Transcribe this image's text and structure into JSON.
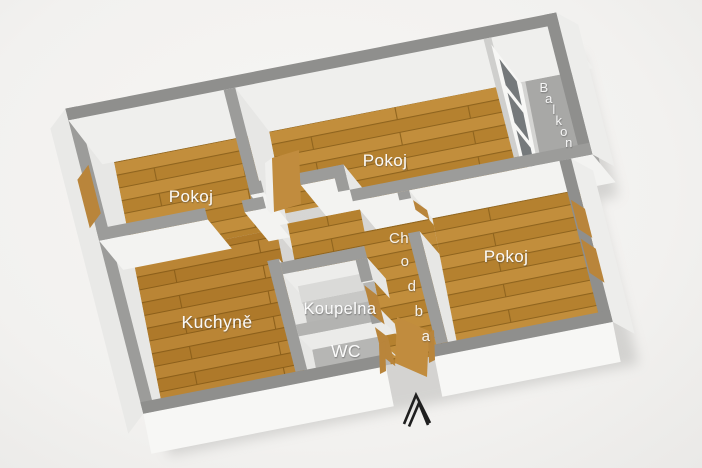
{
  "floorplan": {
    "type": "3d-floor-plan",
    "rooms": [
      {
        "id": "pokoj-left",
        "label": "Pokoj",
        "floor": "wood"
      },
      {
        "id": "pokoj-middle",
        "label": "Pokoj",
        "floor": "wood"
      },
      {
        "id": "pokoj-right",
        "label": "Pokoj",
        "floor": "wood"
      },
      {
        "id": "kuchyne",
        "label": "Kuchyně",
        "floor": "wood"
      },
      {
        "id": "koupelna",
        "label": "Koupelna",
        "floor": "tile"
      },
      {
        "id": "wc",
        "label": "WC",
        "floor": "tile"
      },
      {
        "id": "chodba",
        "label": "Chodba",
        "floor": "wood"
      },
      {
        "id": "balkon",
        "label": "Balkon",
        "floor": "concrete"
      }
    ],
    "colors": {
      "background": "#f2f1ef",
      "wall_face": "#f3f3f1",
      "wall_face_shade": "#e7e7e5",
      "wall_face_bright": "#f7f7f5",
      "wall_top": "#9c9c9a",
      "wall_top_outer": "#8f8f8d",
      "floor_wood": "#b5812f",
      "floor_wood_light": "#c28e3c",
      "floor_wood_seam": "#8f641e",
      "floor_tile": "#b6b6b4",
      "floor_balcony": "#a8a8a6",
      "door_wood": "#c18c3e",
      "trim_wood": "#b9853b",
      "glass": "#75797b",
      "label": "#ffffff",
      "arrow": "#1f1f1f"
    }
  }
}
